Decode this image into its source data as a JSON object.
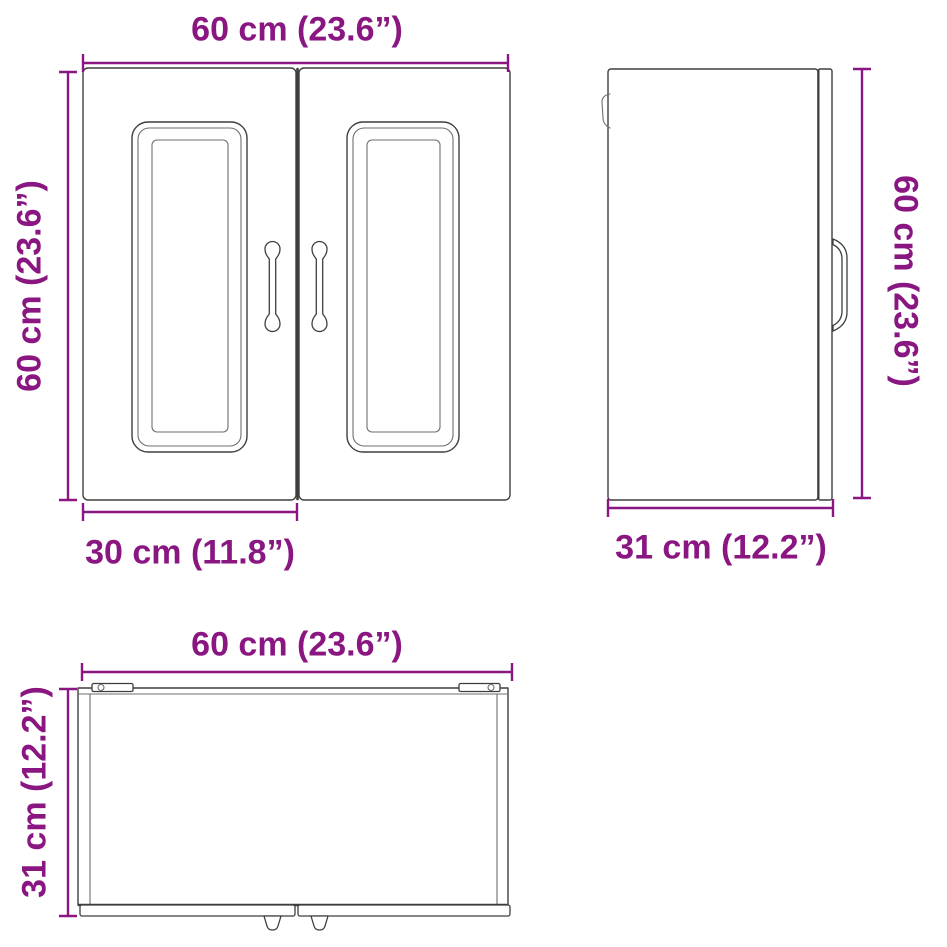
{
  "colors": {
    "accent": "#8A1682",
    "line": "#3E3E3E",
    "background": "#FFFFFF"
  },
  "views": {
    "front": {
      "width": "60 cm (23.6”)",
      "height": "60 cm (23.6”)",
      "door_width": "30 cm (11.8”)"
    },
    "side": {
      "height": "60 cm (23.6”)",
      "depth": "31 cm (12.2”)"
    },
    "top": {
      "width": "60 cm (23.6”)",
      "depth": "31 cm (12.2”)"
    }
  }
}
